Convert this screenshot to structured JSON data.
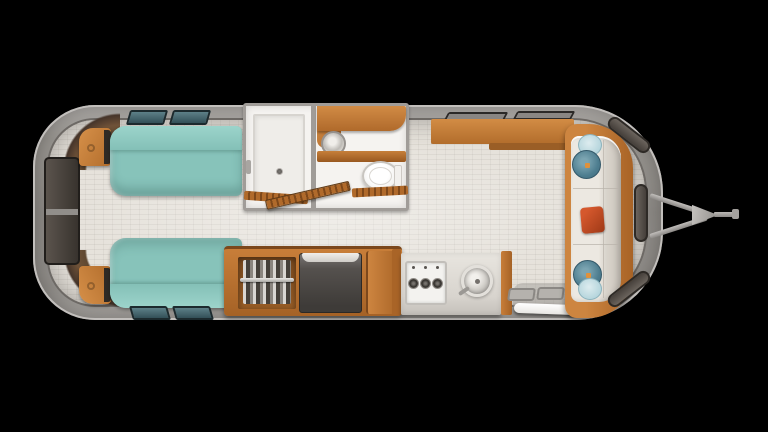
{
  "meta": {
    "view": "top-down floor plan",
    "subject": "travel trailer interior",
    "canvas": {
      "width": 768,
      "height": 432
    },
    "background_color": "#000000",
    "visible_text": []
  },
  "palette": {
    "shell_gray": "#8c8985",
    "shell_rim": "#c2bfbc",
    "wall_line": "#6d6965",
    "floor_beige": "#e6e2db",
    "wood_light": "#d28c45",
    "wood_mid": "#b26d2c",
    "wood_dark": "#7c481c",
    "bed_teal": "#87c3ba",
    "bed_bolster_teal": "#9cd4cb",
    "side_window_tint": "#335058",
    "front_glass_dark": "#453f3a",
    "bathroom_white": "#f5f3f0",
    "fixture_gray": "#b8b5b0",
    "fridge_gray": "#3e3b38",
    "counter_light": "#d8d4ce",
    "sofa_cushion_cream": "#e6e2da",
    "pillow_round_dark_teal": "#4d7d8f",
    "pillow_round_light_blue": "#a6ccd5",
    "pillow_square_orange": "#c14a24",
    "pillow_button_orange": "#e0913b",
    "hitch_gray": "#a3a09d"
  },
  "zones": {
    "bedroom": {
      "label": "rear twin bedroom",
      "items": [
        "twin-bed-top",
        "twin-bed-bottom",
        "nightstand-top",
        "nightstand-bottom",
        "rear-window",
        "bed-window-top-1",
        "bed-window-top-2",
        "bed-window-bottom-1",
        "bed-window-bottom-2",
        "corner-trim-top-left",
        "corner-trim-bottom-left"
      ]
    },
    "bathroom": {
      "label": "center bathroom",
      "items": [
        "shower-pan",
        "shower-drain",
        "shower-fixture",
        "vanity-counter",
        "bathroom-sink",
        "vanity-shelf",
        "toilet",
        "toilet-tank",
        "bathroom-door-open",
        "bathroom-divider-wall"
      ]
    },
    "storage": {
      "label": "wardrobe and refrigerator unit",
      "items": [
        "wardrobe-opening",
        "hangers",
        "wardrobe-rail",
        "refrigerator",
        "cabinet-door-right"
      ]
    },
    "galley": {
      "label": "galley kitchen",
      "items": [
        "kitchen-counter",
        "cooktop",
        "burner-1",
        "burner-2",
        "burner-3",
        "kitchen-sink",
        "faucet",
        "overhead-cabinet",
        "galley-window-1",
        "galley-window-2"
      ]
    },
    "entry": {
      "label": "entry door and steps",
      "items": [
        "entry-door",
        "entry-step-1",
        "entry-step-2",
        "entry-landing",
        "entry-mat"
      ]
    },
    "lounge": {
      "label": "front sofa lounge",
      "items": [
        "sofa-frame",
        "sofa-cushion",
        "round-pillow-light-top",
        "round-pillow-dark-top",
        "square-pillow",
        "round-pillow-dark-bottom",
        "round-pillow-light-bottom",
        "front-window-top",
        "front-window-middle",
        "front-window-bottom"
      ]
    },
    "exterior": {
      "label": "trailer shell and hitch",
      "items": [
        "trailer-shell",
        "trailer-floor",
        "hitch-bar-top",
        "hitch-bar-bottom",
        "hitch-coupler",
        "hitch-tongue",
        "hitch-tip"
      ]
    }
  }
}
